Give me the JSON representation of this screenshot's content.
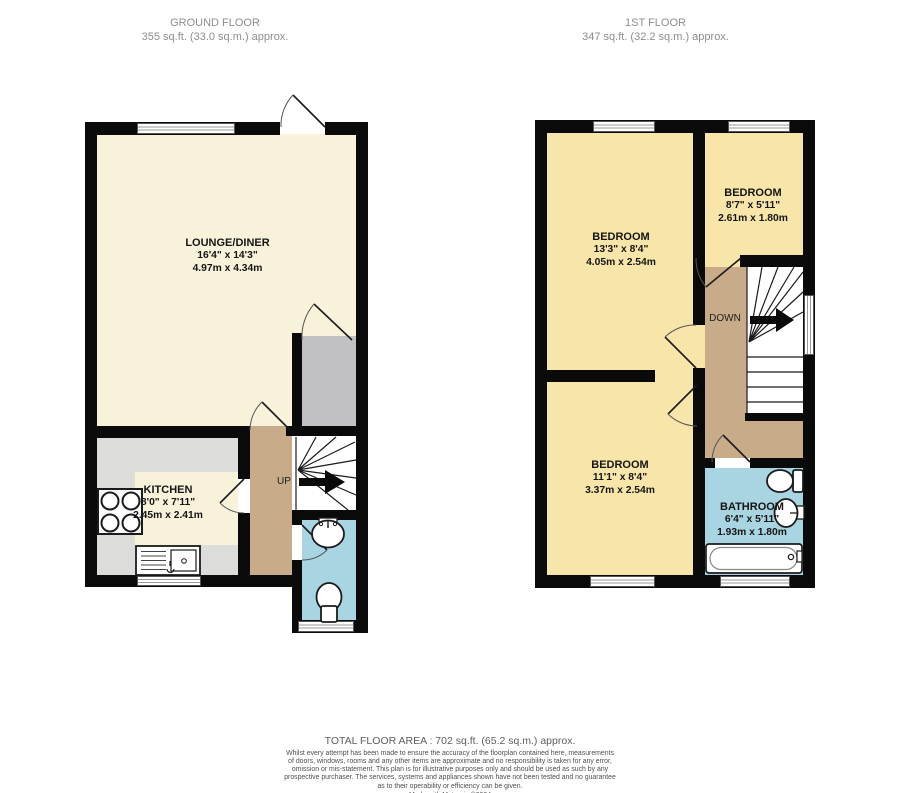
{
  "header": {
    "ground_title": "GROUND FLOOR",
    "ground_area": "355 sq.ft. (33.0 sq.m.) approx.",
    "first_title": "1ST FLOOR",
    "first_area": "347 sq.ft. (32.2 sq.m.) approx."
  },
  "ground": {
    "stairs": "UP",
    "lounge": {
      "name": "LOUNGE/DINER",
      "imperial": "16'4\"  x 14'3\"",
      "metric": "4.97m  x 4.34m"
    },
    "kitchen": {
      "name": "KITCHEN",
      "imperial": "8'0\"  x 7'11\"",
      "metric": "2.45m  x 2.41m"
    }
  },
  "first": {
    "stairs": "DOWN",
    "bedroom1": {
      "name": "BEDROOM",
      "imperial": "13'3\"  x 8'4\"",
      "metric": "4.05m  x 2.54m"
    },
    "bedroom2": {
      "name": "BEDROOM",
      "imperial": "8'7\"  x 5'11\"",
      "metric": "2.61m  x 1.80m"
    },
    "bedroom3": {
      "name": "BEDROOM",
      "imperial": "11'1\"  x 8'4\"",
      "metric": "3.37m  x 2.54m"
    },
    "bathroom": {
      "name": "BATHROOM",
      "imperial": "6'4\"  x 5'11\"",
      "metric": "1.93m  x 1.80m"
    }
  },
  "footer": {
    "total_area": "TOTAL FLOOR AREA : 702 sq.ft. (65.2 sq.m.) approx.",
    "disclaimer": "Whilst every attempt has been made to ensure the accuracy of the floorplan contained here, measurements of doors, windows, rooms and any other items are approximate and no responsibility is taken for any error, omission or mis-statement. This plan is for illustrative purposes only and should be used as such by any prospective purchaser. The services, systems and appliances shown have not been tested and no guarantee as to their operability or efficiency can be given.",
    "credit": "Made with Metropix ©2024"
  },
  "colors": {
    "room_ground": "#F8F2DB",
    "room_first": "#F7E5A9",
    "hall": "#C8AC89",
    "wet": "#A9D4E2",
    "counter": "#DCDCDB",
    "storage": "#C1C1C5",
    "wall": "#0A0A0A"
  }
}
